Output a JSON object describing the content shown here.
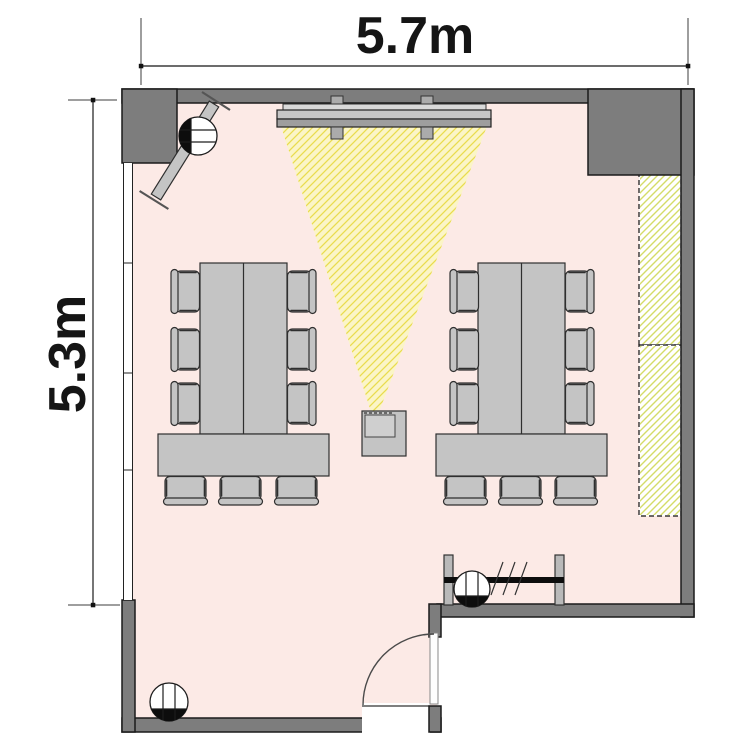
{
  "dimensions": {
    "width_label": "5.7m",
    "height_label": "5.3m"
  },
  "room": {
    "width_meters": 5.7,
    "depth_meters": 5.3
  },
  "colors": {
    "wall": "#7d7d7d",
    "floor": "#fceae6",
    "furniture": "#c4c4c4",
    "beamfill": "#fbf6c3",
    "beamhatch": "#e9dc4e",
    "cabinethatch": "#d4dc68",
    "ink": "#1b1b1b"
  },
  "objects": {
    "table_groups": 2,
    "long_tables_per_group": 2,
    "end_tables_per_group": 1,
    "chairs_total": 18,
    "fixtures": [
      "projection-screen",
      "projector",
      "projection-beam",
      "wall-cabinet-upper",
      "wall-cabinet-lower",
      "radiator",
      "door",
      "window",
      "coat-rack",
      "floor-marker-top-left",
      "floor-marker-bottom-left",
      "floor-marker-bottom-right"
    ]
  }
}
